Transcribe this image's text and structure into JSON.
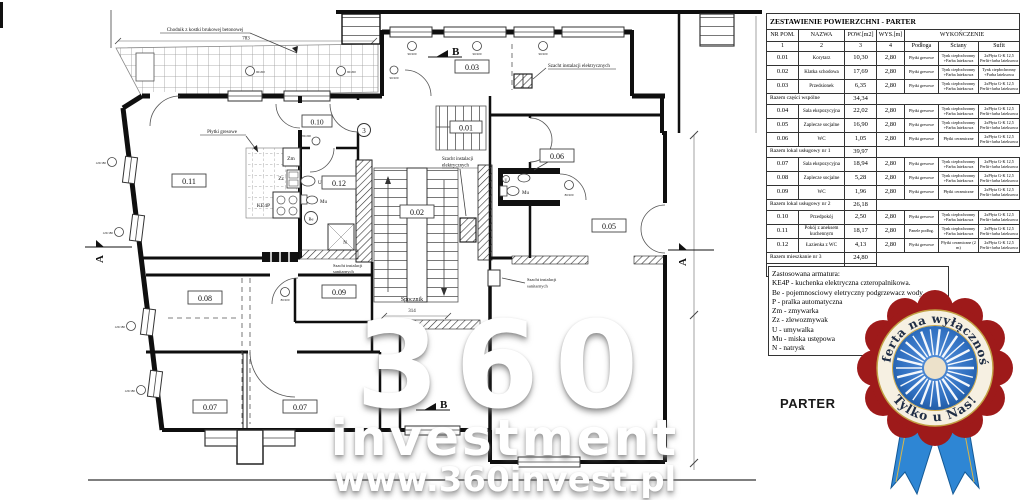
{
  "table": {
    "title": "ZESTAWIENIE POWIERZCHNI - PARTER",
    "headers": {
      "nr": "NR POM.",
      "nazwa": "NAZWA",
      "pow": "POW.[m2]",
      "wys": "WYS.[m]",
      "wyk": "WYKOŃCZENIE",
      "podloga": "Podłoga",
      "sciany": "Ściany",
      "sufit": "Sufit",
      "nums": [
        "1",
        "2",
        "3",
        "4"
      ]
    },
    "sections": [
      {
        "rows": [
          {
            "nr": "0.01",
            "nazwa": "Korytarz",
            "pow": "10,30",
            "wys": "2,80",
            "podloga": "Płytki gresowe",
            "sciany": "Tynk ciepłochronny +Farba lateksowa",
            "sufit": "2xPłyta G-K 12,5 Perlit+farba lateksowa"
          },
          {
            "nr": "0.02",
            "nazwa": "Klatka schodowa",
            "pow": "17,69",
            "wys": "2,80",
            "podloga": "Płytki gresowe",
            "sciany": "Tynk ciepłochronny +Farba lateksowa",
            "sufit": "Tynk ciepłochronny +Farba lateksowa"
          },
          {
            "nr": "0.03",
            "nazwa": "Przedsionek",
            "pow": "6,35",
            "wys": "2,80",
            "podloga": "Płytki gresowe",
            "sciany": "Tynk ciepłochronny +Farba lateksowa",
            "sufit": "2xPłyta G-K 12,5 Perlit+farba lateksowa"
          }
        ],
        "summary": {
          "label": "Razem części wspólne",
          "value": "34,34"
        }
      },
      {
        "rows": [
          {
            "nr": "0.04",
            "nazwa": "Sala ekspozycyjna",
            "pow": "22,02",
            "wys": "2,80",
            "podloga": "Płytki gresowe",
            "sciany": "Tynk ciepłochronny +Farba lateksowa",
            "sufit": "2xPłyta G-K 12,5 Perlit+farba lateksowa"
          },
          {
            "nr": "0.05",
            "nazwa": "Zaplecze socjalne",
            "pow": "16,90",
            "wys": "2,80",
            "podloga": "Płytki gresowe",
            "sciany": "Tynk ciepłochronny +Farba lateksowa",
            "sufit": "2xPłyta G-K 12,5 Perlit+farba lateksowa"
          },
          {
            "nr": "0.06",
            "nazwa": "WC",
            "pow": "1,05",
            "wys": "2,80",
            "podloga": "Płytki gresowe",
            "sciany": "Płytki ceramiczne",
            "sufit": "2xPłyta G-K 12,5 Perlit+farba lateksowa"
          }
        ],
        "summary": {
          "label": "Razem lokal usługowy nr 1",
          "value": "39,97"
        }
      },
      {
        "rows": [
          {
            "nr": "0.07",
            "nazwa": "Sala ekspozycyjna",
            "pow": "18,94",
            "wys": "2,80",
            "podloga": "Płytki gresowe",
            "sciany": "Tynk ciepłochronny +Farba lateksowa",
            "sufit": "2xPłyta G-K 12,5 Perlit+farba lateksowa"
          },
          {
            "nr": "0.08",
            "nazwa": "Zaplecze socjalne",
            "pow": "5,28",
            "wys": "2,80",
            "podloga": "Płytki gresowe",
            "sciany": "Tynk ciepłochronny +Farba lateksowa",
            "sufit": "2xPłyta G-K 12,5 Perlit+farba lateksowa"
          },
          {
            "nr": "0.09",
            "nazwa": "WC",
            "pow": "1,96",
            "wys": "2,80",
            "podloga": "Płytki gresowe",
            "sciany": "Płytki ceramiczne",
            "sufit": "2xPłyta G-K 12,5 Perlit+farba lateksowa"
          }
        ],
        "summary": {
          "label": "Razem lokal usługowy nr 2",
          "value": "26,18"
        }
      },
      {
        "rows": [
          {
            "nr": "0.10",
            "nazwa": "Przedpokój",
            "pow": "2,50",
            "wys": "2,80",
            "podloga": "Płytki gresowe",
            "sciany": "Tynk ciepłochronny +Farba lateksowa",
            "sufit": "2xPłyta G-K 12,5 Perlit+farba lateksowa"
          },
          {
            "nr": "0.11",
            "nazwa": "Pokój z aneksem kuchennym",
            "pow": "18,17",
            "wys": "2,80",
            "podloga": "Panele podłog.",
            "sciany": "Tynk ciepłochronny +Farba lateksowa",
            "sufit": "2xPłyta G-K 12,5 Perlit+farba lateksowa"
          },
          {
            "nr": "0.12",
            "nazwa": "Łazienka z WC",
            "pow": "4,13",
            "wys": "2,80",
            "podloga": "Płytki gresowe",
            "sciany": "Płytki ceramiczne (2 m)",
            "sufit": "2xPłyta G-K 12,5 Perlit+farba lateksowa"
          }
        ],
        "summary": {
          "label": "Razem mieszkanie nr 3",
          "value": "24,80"
        }
      }
    ],
    "total": {
      "label": "RAZEM CAŁE PIĘTRO",
      "value": "125,29"
    }
  },
  "legend": {
    "lines": [
      "Zastosowana armatura:",
      "KE4P - kuchenka elektryczna czteropalnikowa.",
      "Be - pojemnosciowy eletryczny podgrzewacz wody.",
      "P - pralka automatyczna",
      "Zm - zmywarka",
      "Zz - zlewozmywak",
      "U - umywalka",
      "Mu - miska ustępowa",
      "N - natrysk"
    ]
  },
  "floor_label": "PARTER",
  "watermark": {
    "big": "360",
    "mid": "investment",
    "url": "www.360invest.pl"
  },
  "badge": {
    "line1": "Oferta na wyłączność",
    "line2": "Tylko u Nas!",
    "red": "#9e1a1a",
    "blue": "#2f6fc0",
    "ribbon": "#2e86d4"
  },
  "plan": {
    "rooms": {
      "r01": "0.01",
      "r02": "0.02",
      "r03": "0.03",
      "r05": "0.05",
      "r06": "0.06",
      "r07a": "0.07",
      "r07b": "0.07",
      "r08": "0.08",
      "r09": "0.09",
      "r10": "0.10",
      "r11": "0.11",
      "r12": "0.12"
    },
    "labels": {
      "chodnik": "Chodnik z kostki brukowej betonowej",
      "dim783": "783",
      "dim314": "314",
      "spocznik": "Spocznik",
      "szacht_el": "Szacht instalacji elektrycznych",
      "szacht_l1": "Szacht instalacji",
      "szacht_el_l2": "elektrycznych",
      "szacht_san_l2": "sanitarnych",
      "plytki": "Płytki gresowe",
      "axis3": "3"
    },
    "fixtures": {
      "ke4p": "KE4P",
      "be": "Be",
      "zm": "Zm",
      "zz": "Zz",
      "u": "U",
      "mu": "Mu",
      "n": "N"
    },
    "sections": {
      "a": "A",
      "b": "B"
    },
    "tags": {
      "t90": "90/200",
      "t120": "120/180",
      "t80": "80/200"
    }
  }
}
